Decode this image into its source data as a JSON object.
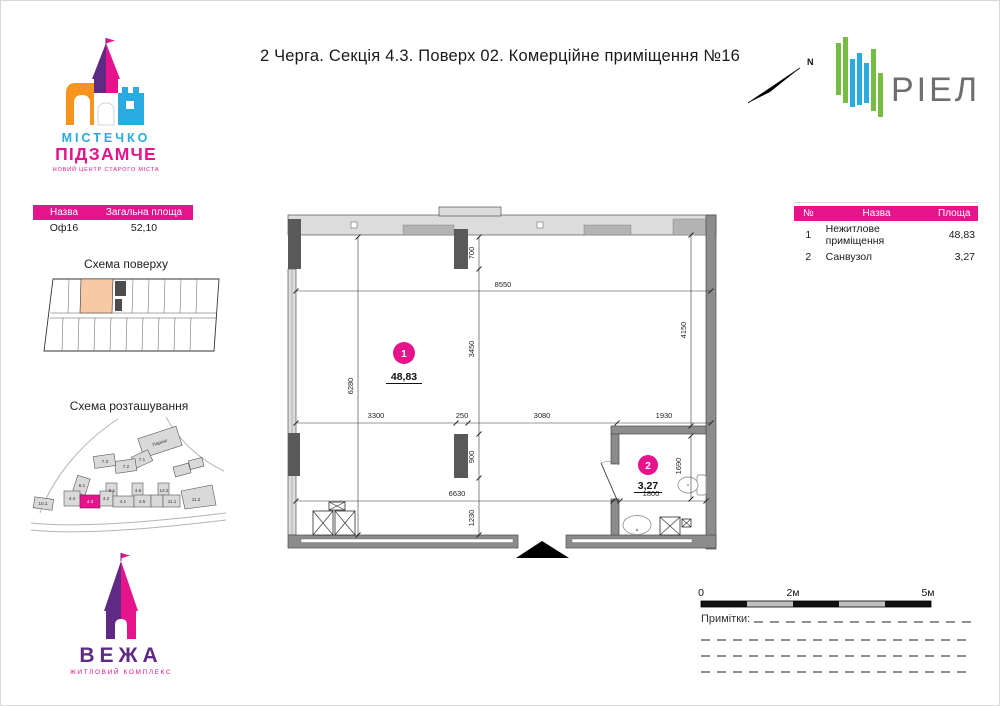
{
  "title": "2 Черга. Секція 4.3. Поверх 02. Комерційне приміщення №16",
  "brand": {
    "mistechko_line1": "МІСТЕЧКО",
    "mistechko_line2": "ПІДЗАМЧЕ",
    "mistechko_tagline": "НОВИЙ ЦЕНТР СТАРОГО МІСТА",
    "riel": "РІЕЛ",
    "vezha_name": "ВЕЖА",
    "vezha_tagline": "ЖИТЛОВИЙ КОМПЛЕКС",
    "north": "N"
  },
  "unit_table": {
    "header_name": "Назва",
    "header_area": "Загальна площа",
    "unit_name": "Оф16",
    "unit_area": "52,10"
  },
  "floor_scheme_title": "Схема поверху",
  "site_scheme_title": "Схема розташування",
  "site": {
    "labels": [
      "Паркінг",
      "7.1",
      "7.2",
      "7.3",
      "6.1",
      "5.1",
      "4.6",
      "14.2",
      "10.1",
      "4.4",
      "4.3",
      "4.2",
      "4.1",
      "4.5",
      "11.1",
      "11.2"
    ]
  },
  "rooms_table": {
    "header_num": "№",
    "header_name": "Назва",
    "header_area": "Площа",
    "rows": [
      {
        "num": "1",
        "name": "Нежитлове приміщення",
        "area": "48,83"
      },
      {
        "num": "2",
        "name": "Санвузол",
        "area": "3,27"
      }
    ]
  },
  "plan": {
    "dim_top": "8550",
    "dim_niche": "700",
    "dim_center_v": "3450",
    "dim_right_v": "4150",
    "dim_left_v": "6280",
    "dim_seg_1": "3300",
    "dim_seg_2": "250",
    "dim_seg_3": "3080",
    "dim_seg_4": "1930",
    "dim_column": "900",
    "dim_bottom": "6630",
    "dim_bottom_v": "1230",
    "dim_wc_w": "1800",
    "dim_wc_v": "1690",
    "room1_num": "1",
    "room1_area": "48,83",
    "room2_num": "2",
    "room2_area": "3,27"
  },
  "scale_bar": {
    "t0": "0",
    "t1": "2м",
    "t2": "5м"
  },
  "notes_label": "Примітки:",
  "colors": {
    "accent": "#E6148C",
    "purple": "#5F2A84",
    "blue": "#29ABE2",
    "orange": "#F7941D",
    "green": "#76BC43",
    "logo_gray": "#6D6E71",
    "wall_gray": "#8C8C8C",
    "window_gray": "#DCDCDC",
    "column_dark": "#595959",
    "highlight_peach": "#F8C9A2"
  }
}
